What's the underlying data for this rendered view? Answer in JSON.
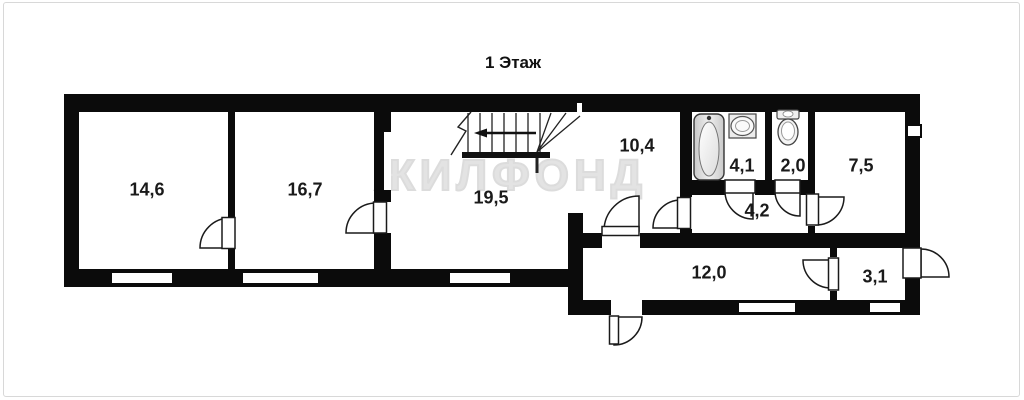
{
  "title": "1 Этаж",
  "watermark": "ЖИЛФОНД",
  "rooms": [
    {
      "id": "room-14-6",
      "area": "14,6"
    },
    {
      "id": "room-16-7",
      "area": "16,7"
    },
    {
      "id": "room-19-5",
      "area": "19,5"
    },
    {
      "id": "hall-10-4",
      "area": "10,4"
    },
    {
      "id": "bathroom-4-1",
      "area": "4,1"
    },
    {
      "id": "wc-2-0",
      "area": "2,0"
    },
    {
      "id": "room-7-5",
      "area": "7,5"
    },
    {
      "id": "hall-4-2",
      "area": "4,2"
    },
    {
      "id": "corridor-12-0",
      "area": "12,0"
    },
    {
      "id": "entry-3-1",
      "area": "3,1"
    }
  ],
  "icons": [
    "bathtub-icon",
    "sink-icon",
    "toilet-icon",
    "staircase",
    "stair-direction-arrow"
  ],
  "colors": {
    "wall": "#0b0b0b",
    "floor": "#ffffff",
    "watermark": "#e0e0e0",
    "label": "#1a1a1a",
    "frame": "#d8d8d8"
  }
}
